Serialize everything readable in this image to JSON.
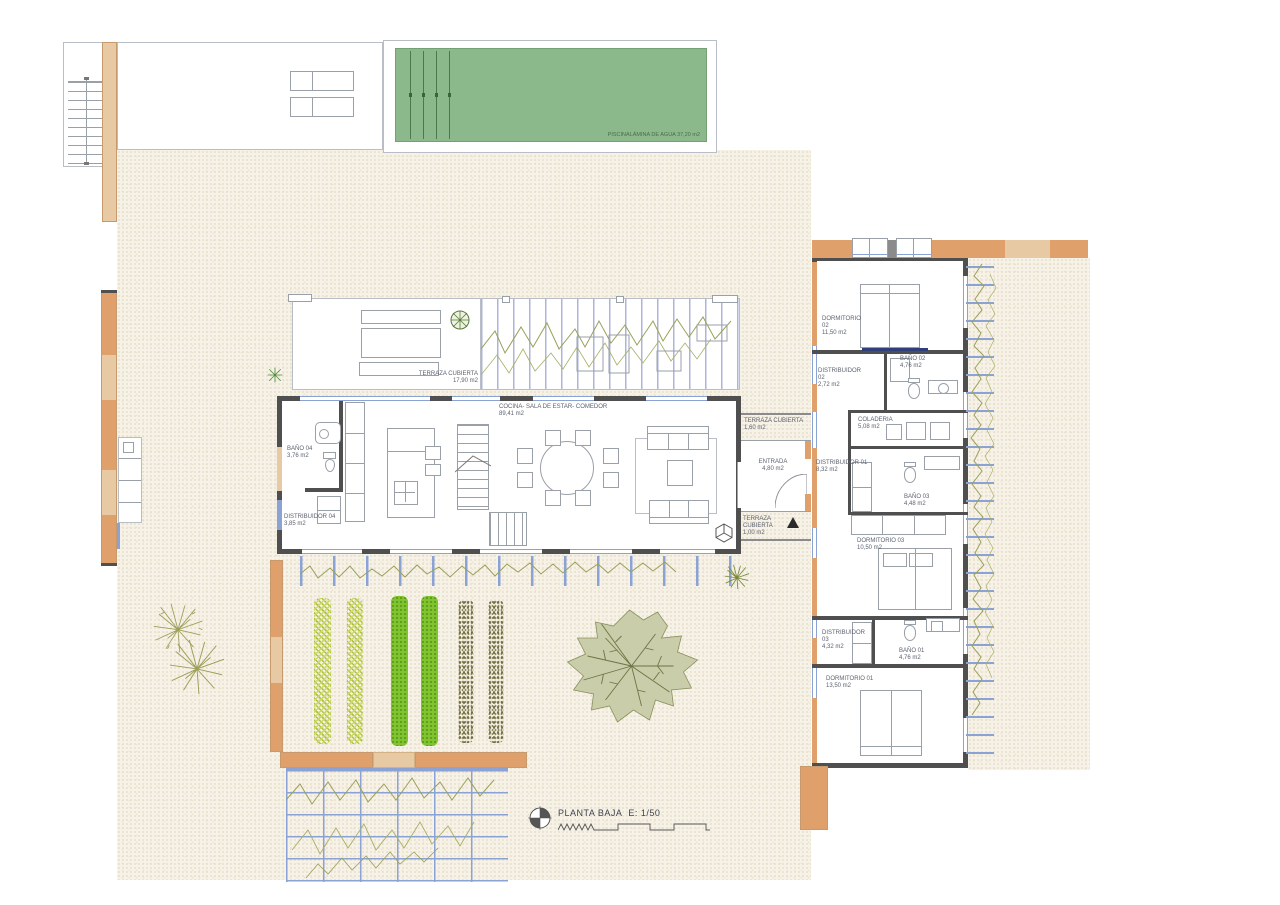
{
  "plan": {
    "title": "PLANTA BAJA",
    "scale": "E: 1/50"
  },
  "pool": {
    "name": "PISCINA",
    "note": "LÁMINA DE AGUA 37,20 m2"
  },
  "rooms": [
    {
      "name": "TERRAZA CUBIERTA",
      "area": "17,90 m2"
    },
    {
      "name": "COCINA- SALA DE ESTAR- COMEDOR",
      "area": "89,41 m2"
    },
    {
      "name": "BAÑO 04",
      "area": "3,76 m2"
    },
    {
      "name": "DISTRIBUIDOR 04",
      "area": "3,85 m2"
    },
    {
      "name": "TERRAZA CUBIERTA",
      "area": "1,60 m2"
    },
    {
      "name": "ENTRADA",
      "area": "4,80 m2"
    },
    {
      "name": "TERRAZA CUBIERTA",
      "area": "1,00 m2"
    },
    {
      "name": "DORMITORIO 02",
      "area": "11,50 m2"
    },
    {
      "name": "DISTRIBUIDOR 02",
      "area": "2,72 m2"
    },
    {
      "name": "BAÑO 02",
      "area": "4,76 m2"
    },
    {
      "name": "COLADERIA",
      "area": "5,08 m2"
    },
    {
      "name": "DISTRIBUIDOR 01",
      "area": "8,32 m2"
    },
    {
      "name": "BAÑO 03",
      "area": "4,48 m2"
    },
    {
      "name": "DORMITORIO 03",
      "area": "10,50 m2"
    },
    {
      "name": "DISTRIBUIDOR 03",
      "area": "4,32 m2"
    },
    {
      "name": "BAÑO 01",
      "area": "4,76 m2"
    },
    {
      "name": "DORMITORIO 01",
      "area": "13,50 m2"
    }
  ],
  "colors": {
    "pool_water": "#8cb98c",
    "wall_orange": "#dfa06b",
    "wall_tan": "#e7c9a4",
    "wall_dark": "#4f4f4f",
    "glass_blue": "#8ba3d4",
    "vine_olive": "#9aa05a",
    "garden_green": "#7fc42e",
    "garden_yellowgreen": "#c6d96a",
    "garden_olive_dots": "#8b8b5e",
    "site_beige": "#f7f2e8"
  }
}
